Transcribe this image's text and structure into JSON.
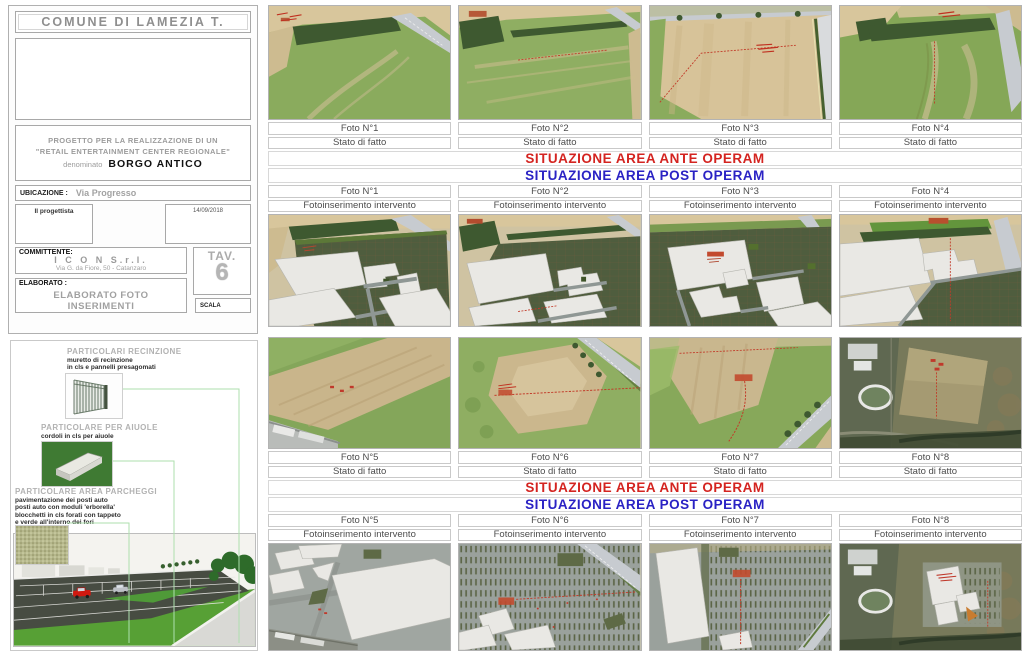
{
  "palette": {
    "banner_red": "#d42420",
    "banner_blue": "#2a22c4",
    "annotation_green": "#aedfae",
    "annotation_red": "#c23a28"
  },
  "title_block": {
    "comune": "COMUNE DI LAMEZIA T.",
    "project_line1": "PROGETTO PER LA REALIZZAZIONE DI UN",
    "project_line2": "\"RETAIL ENTERTAINMENT CENTER REGIONALE\"",
    "project_prefix": "denominato",
    "project_name": "BORGO ANTICO",
    "ubicazione_label": "UBICAZIONE :",
    "ubicazione_value": "Via Progresso",
    "progettista_label": "Il progettista",
    "date": "14/09/2018",
    "committente_label": "COMMITTENTE:",
    "committente_name": "I C O N  S.r.l.",
    "committente_address": "Via G. da Fiore, 50 - Catanzaro",
    "elaborato_label": "ELABORATO :",
    "elaborato_value": "ELABORATO FOTO INSERIMENTI",
    "tav_label": "TAV.",
    "tav_number": "6",
    "scala_label": "SCALA"
  },
  "details_panel": {
    "recinzione": {
      "title": "PARTICOLARI RECINZIONE",
      "captions": [
        "muretto di recinzione",
        "in cls e pannelli presagomati"
      ]
    },
    "aiuole": {
      "title": "PARTICOLARE PER AIUOLE",
      "captions": [
        "cordoli in cls per aiuole"
      ]
    },
    "parcheggi": {
      "title": "PARTICOLARE AREA PARCHEGGI",
      "captions": [
        "pavimentazione dei posti auto",
        "posti auto con moduli 'erborella'",
        "blocchetti in cls forati con tappeto",
        "e verde all'interno dei fori"
      ]
    }
  },
  "banners": {
    "ante_text": "SITUAZIONE AREA ANTE OPERAM",
    "post_text": "SITUAZIONE AREA POST OPERAM"
  },
  "labels": {
    "stato": "Stato di fatto",
    "insert": "Fotoinserimento intervento"
  },
  "sections": [
    {
      "photos": [
        "Foto N°1",
        "Foto N°2",
        "Foto N°3",
        "Foto N°4"
      ]
    },
    {
      "photos": [
        "Foto N°5",
        "Foto N°6",
        "Foto N°7",
        "Foto N°8"
      ]
    }
  ]
}
